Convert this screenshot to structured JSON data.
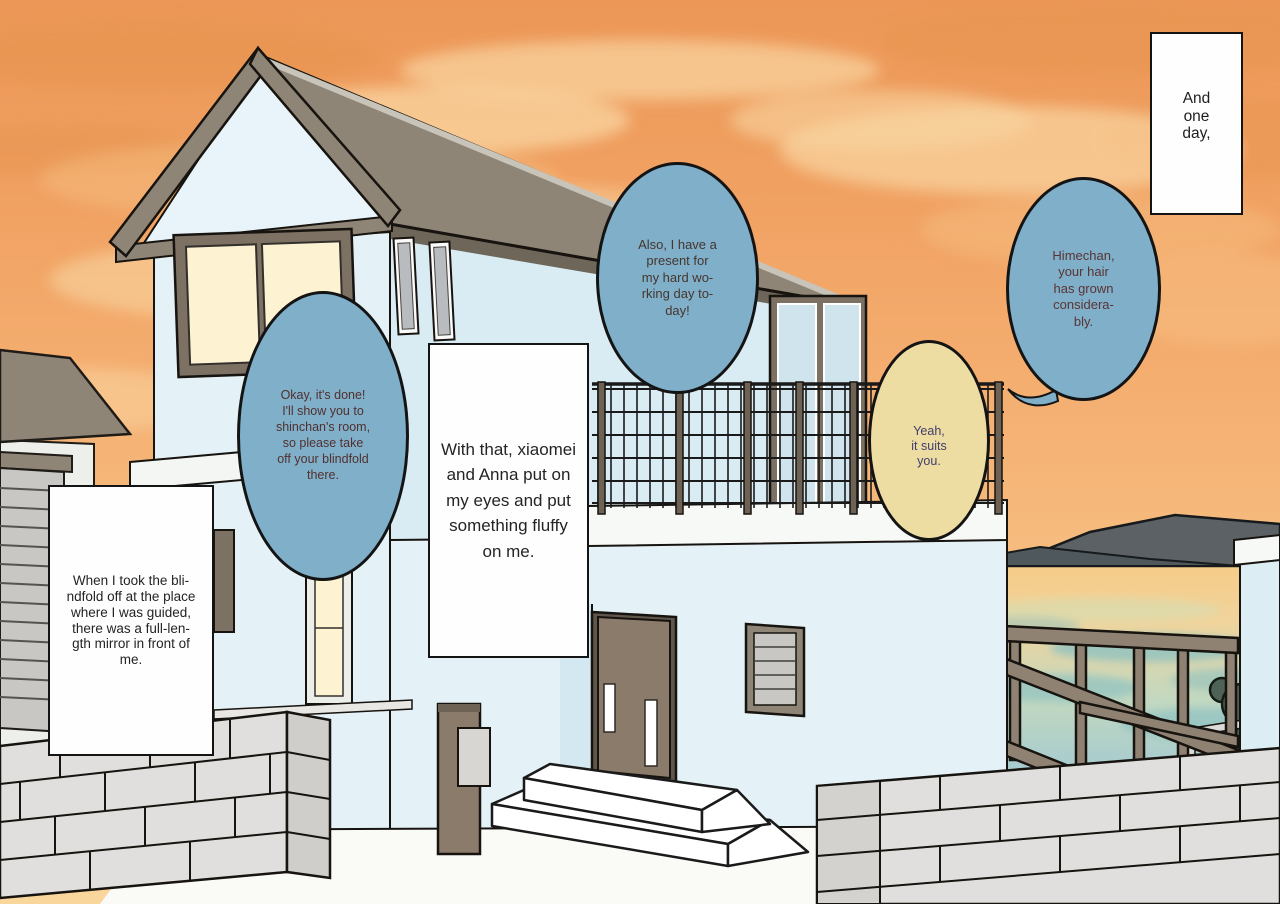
{
  "captions": {
    "and_one_day": "And\none\nday,",
    "with_that": "With that, xiaomei\nand Anna put on\nmy eyes and put\nsomething fluffy\non me.",
    "when_i_took": "When I took the bli-\nndfold off at the place\nwhere I was guided,\nthere was a full-len-\ngth mirror in front of\nme."
  },
  "speech_bubbles": {
    "present": {
      "text": "Also, I have a\npresent for\nmy hard wo-\nrking day to-\nday!",
      "bubble_color": "#7fafc9",
      "text_color": "#46362e"
    },
    "hair_grown": {
      "text": "Himechan,\nyour hair\nhas grown\nconsidera-\nbly.",
      "bubble_color": "#7fafc9",
      "text_color": "#5a3434"
    },
    "blindfold": {
      "text": "Okay, it's done!\nI'll show you to\nshinchan's room,\nso please take\noff your blindfold\nthere.",
      "bubble_color": "#7fafc9",
      "text_color": "#51302f"
    },
    "suits_you": {
      "text": "Yeah,\nit suits\nyou.",
      "bubble_color": "#eedda2",
      "text_color": "#3f3e6c"
    }
  },
  "colors": {
    "sky_top": "#ec9757",
    "sky_bottom": "#f9d69c",
    "speech_bubble_blue": "#7fafc9",
    "speech_bubble_yellow": "#eedda2",
    "caption_box": "#fefefe",
    "house_wall": "#e4f2f8",
    "roof_brown": "#8f8577",
    "window_glow": "#fdf3d2",
    "sea": "#9fc6cf",
    "hills": "#5b6164",
    "trees": "#4e6358",
    "pergola_wood": "#8f8273",
    "block_wall": "#e0dfdd"
  }
}
